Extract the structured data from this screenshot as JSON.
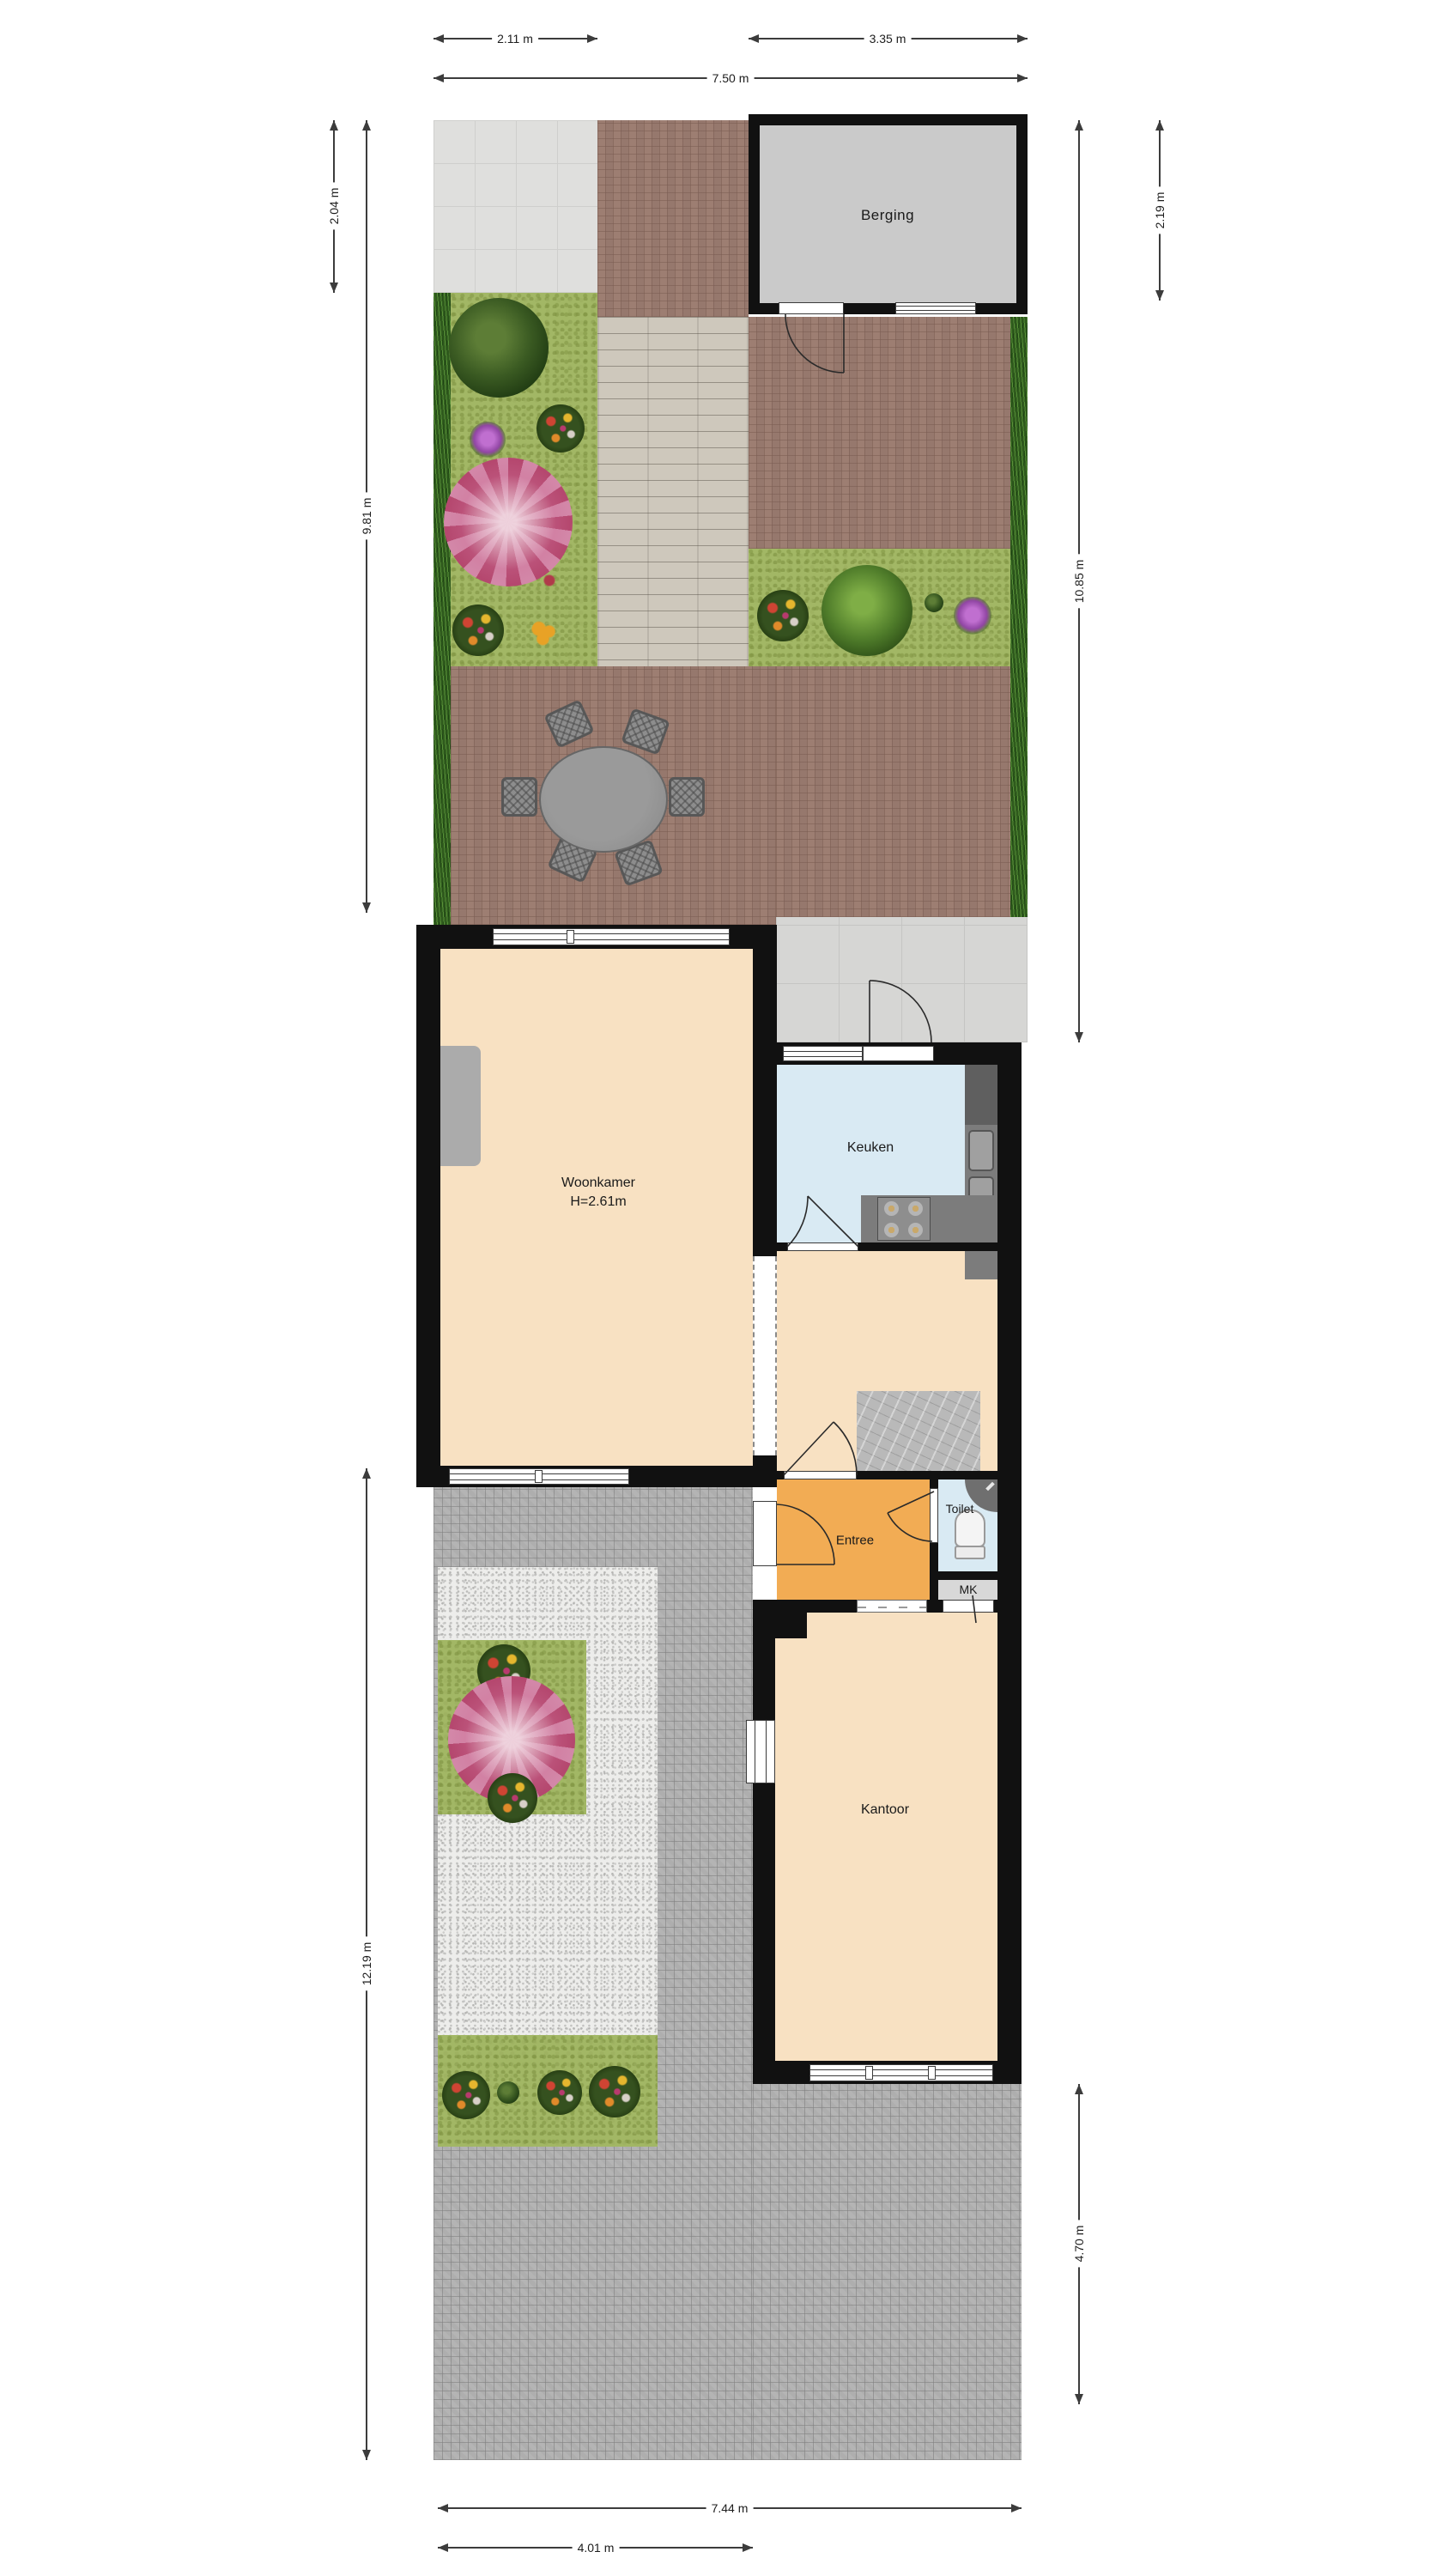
{
  "rooms": {
    "berging": {
      "label": "Berging"
    },
    "woonkamer": {
      "label": "Woonkamer",
      "height_note": "H=2.61m"
    },
    "keuken": {
      "label": "Keuken"
    },
    "entree": {
      "label": "Entree"
    },
    "toilet": {
      "label": "Toilet"
    },
    "mk": {
      "label": "MK"
    },
    "kantoor": {
      "label": "Kantoor"
    }
  },
  "dimensions": {
    "top_left": "2.11 m",
    "top_right": "3.35 m",
    "top_total": "7.50 m",
    "left_upper": "2.04 m",
    "left_garden": "9.81 m",
    "left_front": "12.19 m",
    "right_berging": "2.19 m",
    "right_garden": "10.85 m",
    "right_front": "4.70 m",
    "bottom_total": "7.44 m",
    "bottom_front": "4.01 m"
  },
  "colors": {
    "wall": "#111111",
    "floor_living": "#f8e1c2",
    "floor_kitchen": "#d9eaf3",
    "floor_entry": "#f2ac54",
    "floor_storage": "#cacaca",
    "grass": "#a2b765",
    "brick": "#9a7e72",
    "paving": "#aeaeae",
    "deck": "#cec8bc"
  }
}
